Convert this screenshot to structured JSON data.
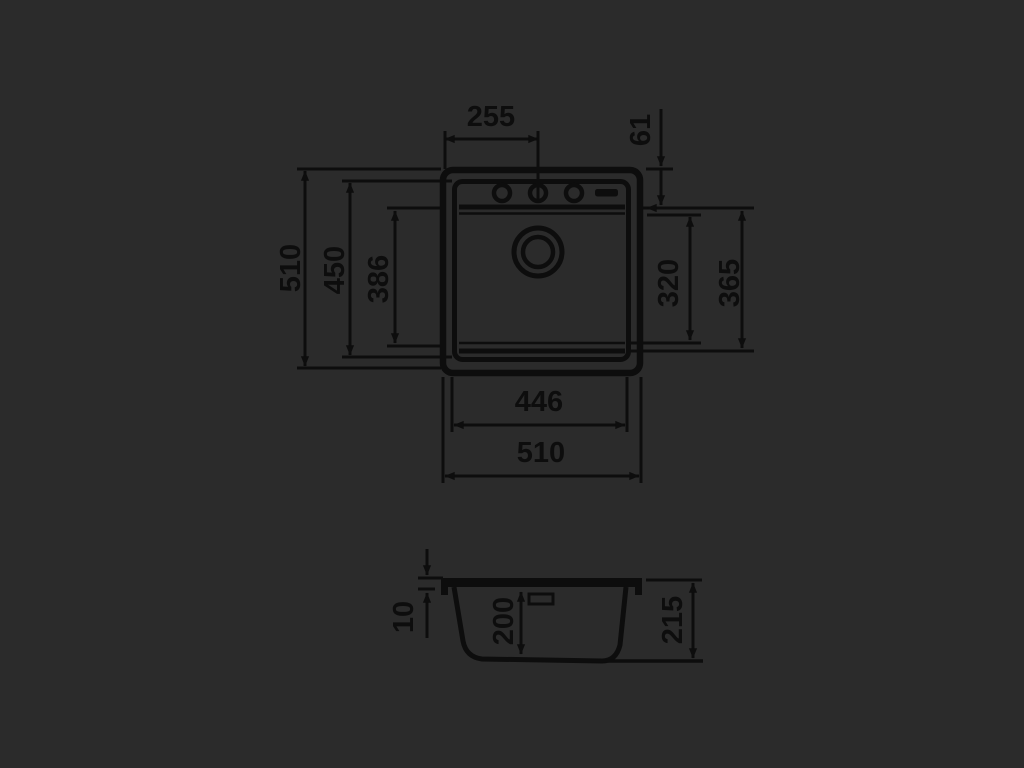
{
  "drawing": {
    "title": "sink-dimension-drawing",
    "colors": {
      "background": "#2b2b2b",
      "line": "#0d0d0d"
    },
    "top_view": {
      "dim_center_offset": "255",
      "dim_hole_row_offset": "61",
      "dim_overall_height": "510",
      "dim_inner_rim_height": "450",
      "dim_bowl_length": "386",
      "dim_bowl_inner_width": "320",
      "dim_bowl_outer_width": "365",
      "dim_bowl_width": "446",
      "dim_overall_width": "510"
    },
    "section_view": {
      "dim_rim_thickness": "10",
      "dim_bowl_depth": "200",
      "dim_total_depth": "215"
    }
  }
}
